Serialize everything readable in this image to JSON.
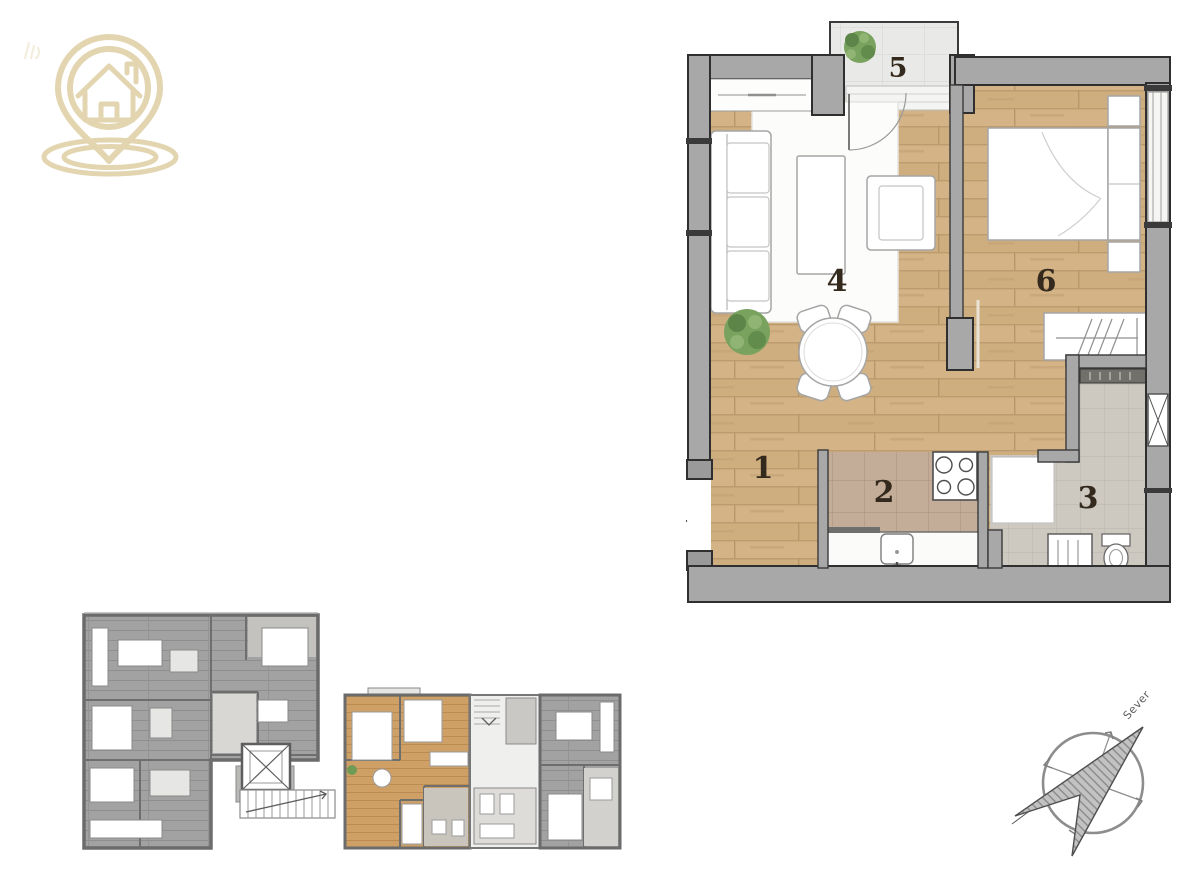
{
  "brand": {
    "logo_icon": "house-location-pin",
    "logo_color": "#e2d5b0"
  },
  "unit_plan": {
    "rooms": [
      {
        "number": "1",
        "name": "hallway"
      },
      {
        "number": "2",
        "name": "kitchen"
      },
      {
        "number": "3",
        "name": "bathroom"
      },
      {
        "number": "4",
        "name": "living room"
      },
      {
        "number": "5",
        "name": "terrace"
      },
      {
        "number": "6",
        "name": "bedroom"
      }
    ],
    "entrance": {
      "label": "1"
    }
  },
  "overview_plan": {
    "highlighted_unit": "one-bedroom unit, center-right",
    "highlight_color": "#cfa066"
  },
  "compass": {
    "north_label": "Sever"
  },
  "palette": {
    "wood": "#d4b487",
    "wood_line": "#bc9c6e",
    "kitchen_tile": "#c4ad98",
    "bath_tile": "#cdc9c1",
    "balcony_tile": "#e9e9e7",
    "wall_fill": "#a8a8a8",
    "wall_edge": "#2f2f2f",
    "overview_gray": "#a2a2a2"
  }
}
